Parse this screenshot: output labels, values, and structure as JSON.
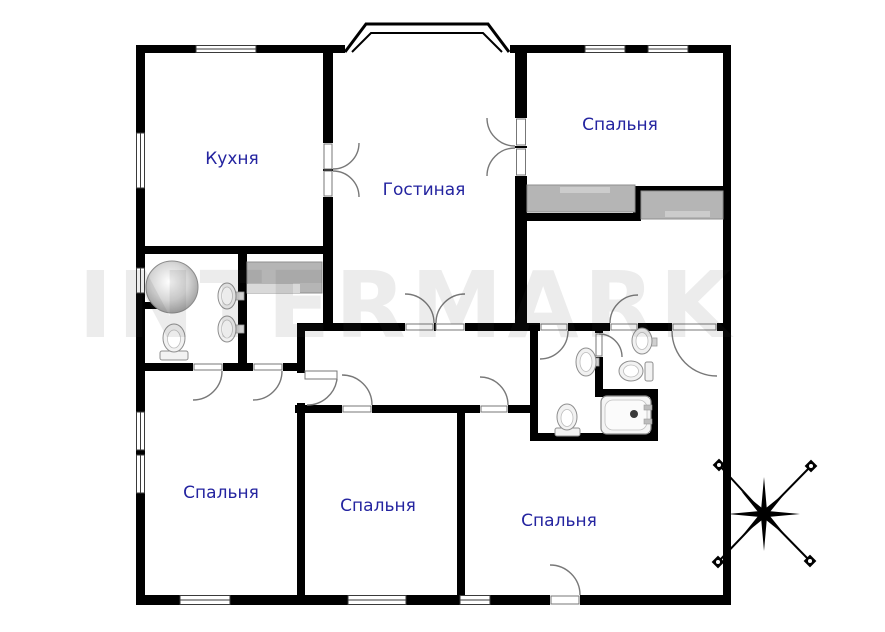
{
  "watermark": {
    "text": "INTERMARK"
  },
  "rooms": {
    "kitchen": {
      "label": "Кухня"
    },
    "living": {
      "label": "Гостиная"
    },
    "bedroom_tr": {
      "label": "Спальня"
    },
    "bedroom_bl": {
      "label": "Спальня"
    },
    "bedroom_bm": {
      "label": "Спальня"
    },
    "bedroom_br": {
      "label": "Спальня"
    }
  },
  "colors": {
    "wall": "#000000",
    "label": "#2424a0",
    "furniture": "#b5b5b5",
    "furniture_light": "#d9d9d9",
    "door_arc": "#787878",
    "fixture_stroke": "#909090",
    "watermark": "rgba(70,70,70,0.10)"
  },
  "compass": {
    "type": "eight-point-star",
    "position": "bottom-right"
  }
}
